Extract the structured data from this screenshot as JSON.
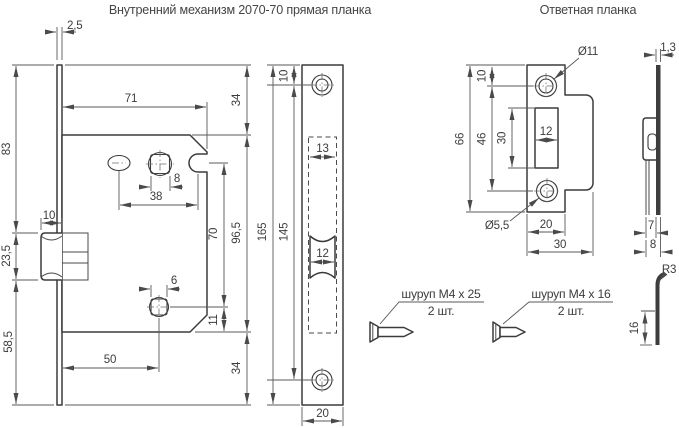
{
  "titles": {
    "left": "Внутренний механизм 2070-70 прямая планка",
    "right": "Ответная планка"
  },
  "lock_view": {
    "faceplate_thickness": "2,5",
    "upper_height": "83",
    "latch_height": "23,5",
    "lower_height": "58,5",
    "latch_width": "10",
    "body_width": "71",
    "top_offset": "34",
    "spindle_square": "8",
    "hole_spacing": "38",
    "notch_to_hole": "70",
    "body_height": "96,5",
    "lower_square": "6",
    "hole_to_bottom": "11",
    "bottom_offset": "34",
    "backset": "50"
  },
  "plate_view": {
    "screw_offset": "10",
    "cutout_width": "13",
    "total_height": "165",
    "screw_spacing": "145",
    "latch_width": "12",
    "plate_width": "20"
  },
  "strike_view": {
    "hole_diameter": "Ø11",
    "screw_offset": "10",
    "total_height": "66",
    "screw_spacing": "46",
    "opening_height": "30",
    "opening_width": "12",
    "screw_diameter": "Ø5,5",
    "plate_width": "20",
    "total_width": "30"
  },
  "strike_profile": {
    "thickness": "1,3",
    "tab_offset_front": "7",
    "tab_offset_back": "8"
  },
  "tab_detail": {
    "bend_radius": "R3",
    "tab_length": "16"
  },
  "screws": {
    "left": {
      "label": "шуруп M4 x 25",
      "qty": "2 шт."
    },
    "right": {
      "label": "шуруп M4 x 16",
      "qty": "2 шт."
    }
  }
}
